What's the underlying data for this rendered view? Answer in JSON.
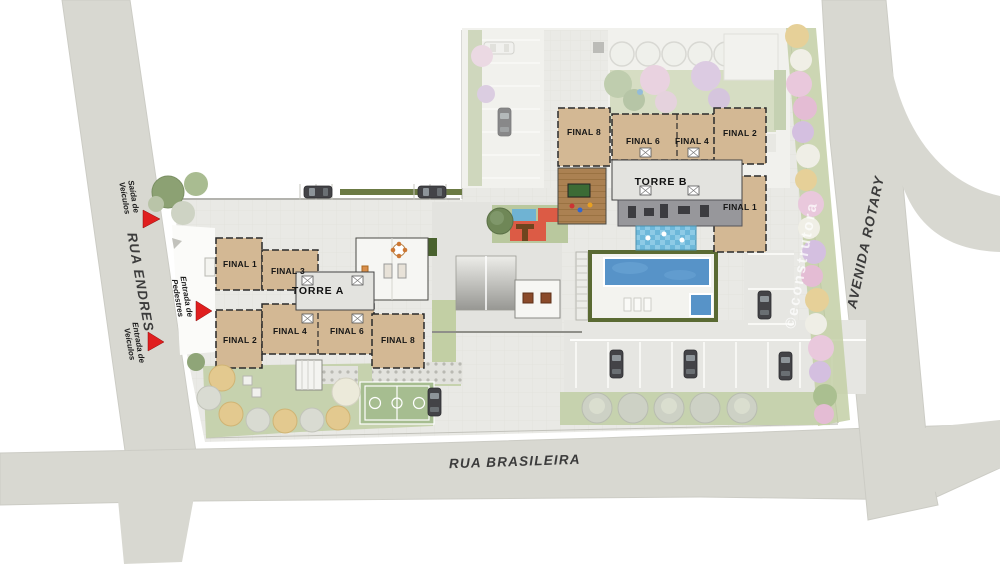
{
  "plan": {
    "streets": {
      "left": "RUA ENDRES",
      "bottom": "RUA BRASILEIRA",
      "right": "AVENIDA ROTARY"
    },
    "markers": {
      "exit_vehicles": {
        "l1": "Saída de",
        "l2": "Veículos"
      },
      "entry_pedestrians": {
        "l1": "Entrada de",
        "l2": "Pedestres"
      },
      "entry_vehicles": {
        "l1": "Entrada de",
        "l2": "Veículos"
      }
    },
    "tower_a": {
      "name": "TORRE A",
      "f1": "FINAL 1",
      "f2": "FINAL 2",
      "f3": "FINAL 3",
      "f4": "FINAL 4",
      "f6": "FINAL 6",
      "f8": "FINAL 8"
    },
    "tower_b": {
      "name": "TORRE B",
      "f1": "FINAL 1",
      "f2": "FINAL 2",
      "f4": "FINAL 4",
      "f6": "FINAL 6",
      "f8": "FINAL 8"
    },
    "watermark": "©econstrutora",
    "colors": {
      "street": "#d8d8d1",
      "site_paving": "#e9e9e5",
      "building_beige": "#d3b894",
      "pool_blue": "#5793c8",
      "lawn_green": "#c6d2ae",
      "hedge_green": "#5a6a33",
      "court_green": "#a6bd90",
      "marker_red": "#e01f1f",
      "play_red": "#dc5b45",
      "kids_blue": "#64b6d9",
      "deck_brown": "#ab8152",
      "gym_gray": "#97979b"
    }
  }
}
